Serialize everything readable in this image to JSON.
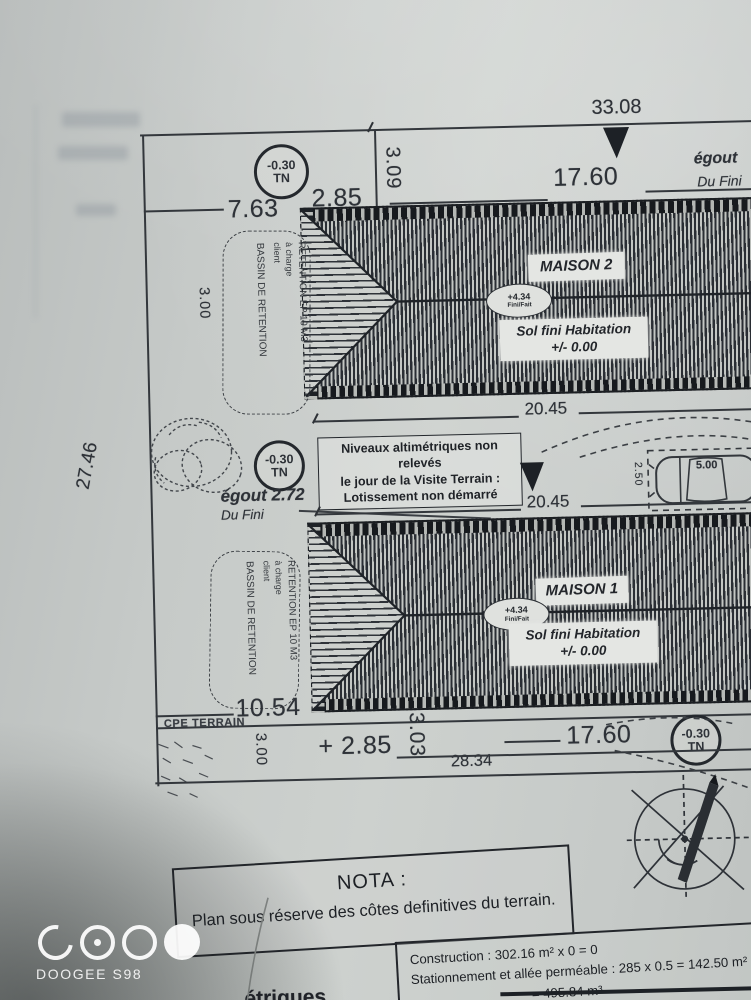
{
  "colors": {
    "paper": "#c7cbc8",
    "ink": "#2e3238",
    "hatch": "#24282d"
  },
  "plan": {
    "tn_badge": {
      "value": "-0.30",
      "unit": "TN"
    },
    "dims": {
      "d33_08": "33.08",
      "d2_85": "2.85",
      "d2_85_plus": "+ 2.85",
      "d3_09": "3.09",
      "d17_60": "17.60",
      "d7_63": "7.63",
      "d20_45": "20.45",
      "d27_46": "27.46",
      "d3_00": "3.00",
      "d10_54": "10.54",
      "d3_03": "3.03",
      "d28_34": "28.34",
      "d5_00": "5.00",
      "d2_50": "2.50"
    },
    "egout_top": {
      "label": "égout",
      "sub": "Du Fini"
    },
    "egout_mid": {
      "label": "égout 2.72",
      "sub": "Du Fini"
    },
    "houses": [
      {
        "name": "MAISON 2",
        "badge_value": "+4.34",
        "badge_label": "Fini/Fait",
        "floor1": "Sol fini Habitation",
        "floor2": "+/- 0.00"
      },
      {
        "name": "MAISON 1",
        "badge_value": "+4.34",
        "badge_label": "Fini/Fait",
        "floor1": "Sol fini Habitation",
        "floor2": "+/- 0.00"
      }
    ],
    "retention": {
      "line1": "RETENTION EP 10 M3",
      "line2": "à charge",
      "line3": "client",
      "basin": "BASSIN DE RETENTION"
    },
    "note": {
      "line1": "Niveaux altimétriques non relevés",
      "line2": "le jour de la Visite Terrain :",
      "line3": "Lotissement non démarré"
    },
    "terrain_label": "CPE TERRAIN",
    "nota": {
      "title": "NOTA :",
      "body": "Plan sous réserve des côtes definitives du terrain."
    },
    "title_block": {
      "line1": "Construction : 302.16 m² x 0 = 0",
      "line2": "Stationnement et allée perméable : 285 x 0.5 = 142.50 m²",
      "line3": "= 495.84 m³",
      "fragment": "étriques"
    }
  },
  "watermark": {
    "device": "DOOGEE S98"
  }
}
